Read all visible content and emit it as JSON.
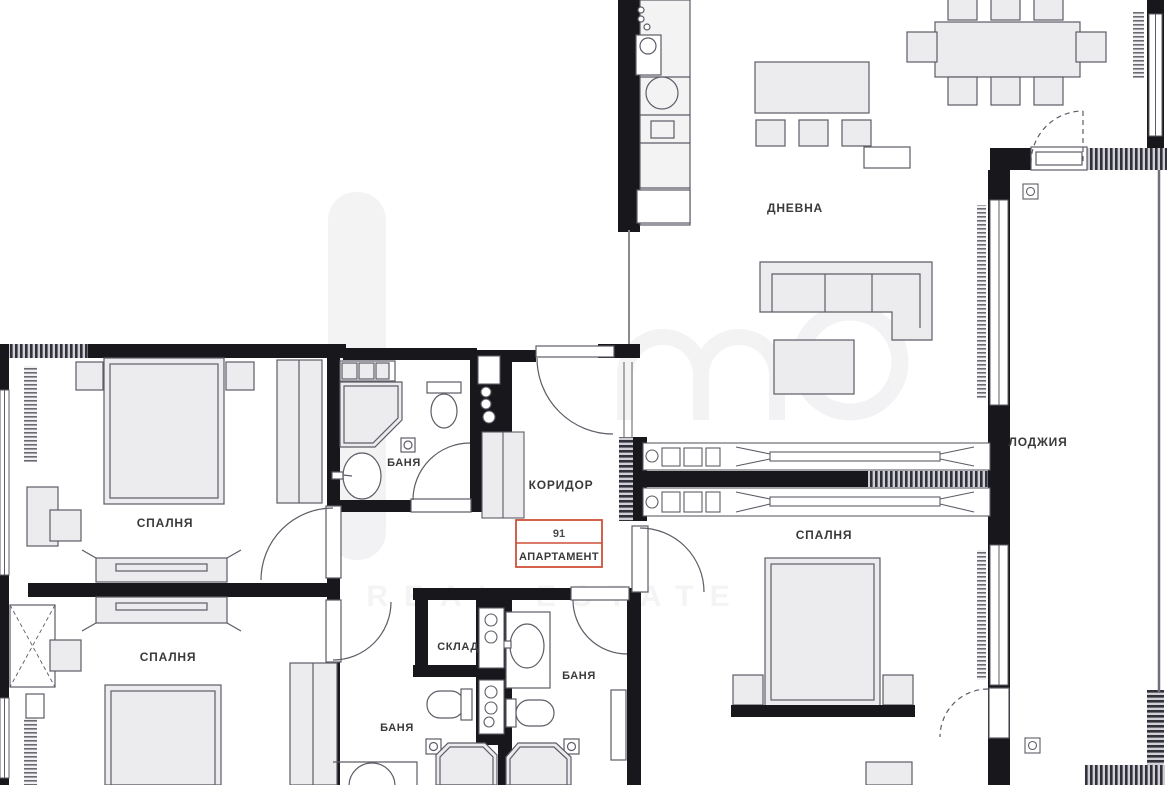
{
  "plan": {
    "apartment_badge": {
      "number": "91",
      "label": "АПАРТАМЕНТ",
      "accent_color": "#cf5038"
    },
    "rooms": {
      "living": {
        "label": "ДНЕВНА"
      },
      "loggia": {
        "label": "ЛОДЖИЯ"
      },
      "corridor": {
        "label": "КОРИДОР"
      },
      "bedroom1": {
        "label": "СПАЛНЯ"
      },
      "bedroom2": {
        "label": "СПАЛНЯ"
      },
      "bedroom3": {
        "label": "СПАЛНЯ"
      },
      "bath1": {
        "label": "БАНЯ"
      },
      "bath2": {
        "label": "БАНЯ"
      },
      "bath3": {
        "label": "БАНЯ"
      },
      "storage": {
        "label": "СКЛАД"
      }
    },
    "watermark": {
      "text": "REAL ESTATE"
    },
    "colors": {
      "wall": "#17171c",
      "furniture_fill": "#ececee",
      "line": "#5c5c66",
      "label_text": "#3a3a3a",
      "badge_accent": "#cf5038",
      "watermark": "#e9e9ec"
    }
  }
}
